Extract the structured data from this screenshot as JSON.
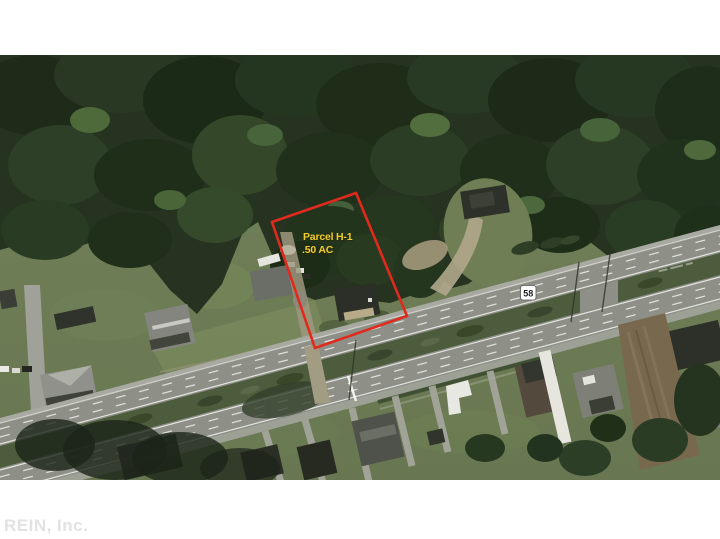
{
  "parcel": {
    "label_line1": "Parcel H-1",
    "label_line2": ".50 AC",
    "label_color": "#F0CD2A",
    "label_shadow_color": "#2B2500",
    "outline_color": "#E02A1E"
  },
  "route_shield": {
    "number": "58",
    "bg": "#FFFFFF",
    "text_color": "#1E1E1E"
  },
  "watermark": {
    "text": "REIN, Inc.",
    "color": "#E2E2E2"
  }
}
